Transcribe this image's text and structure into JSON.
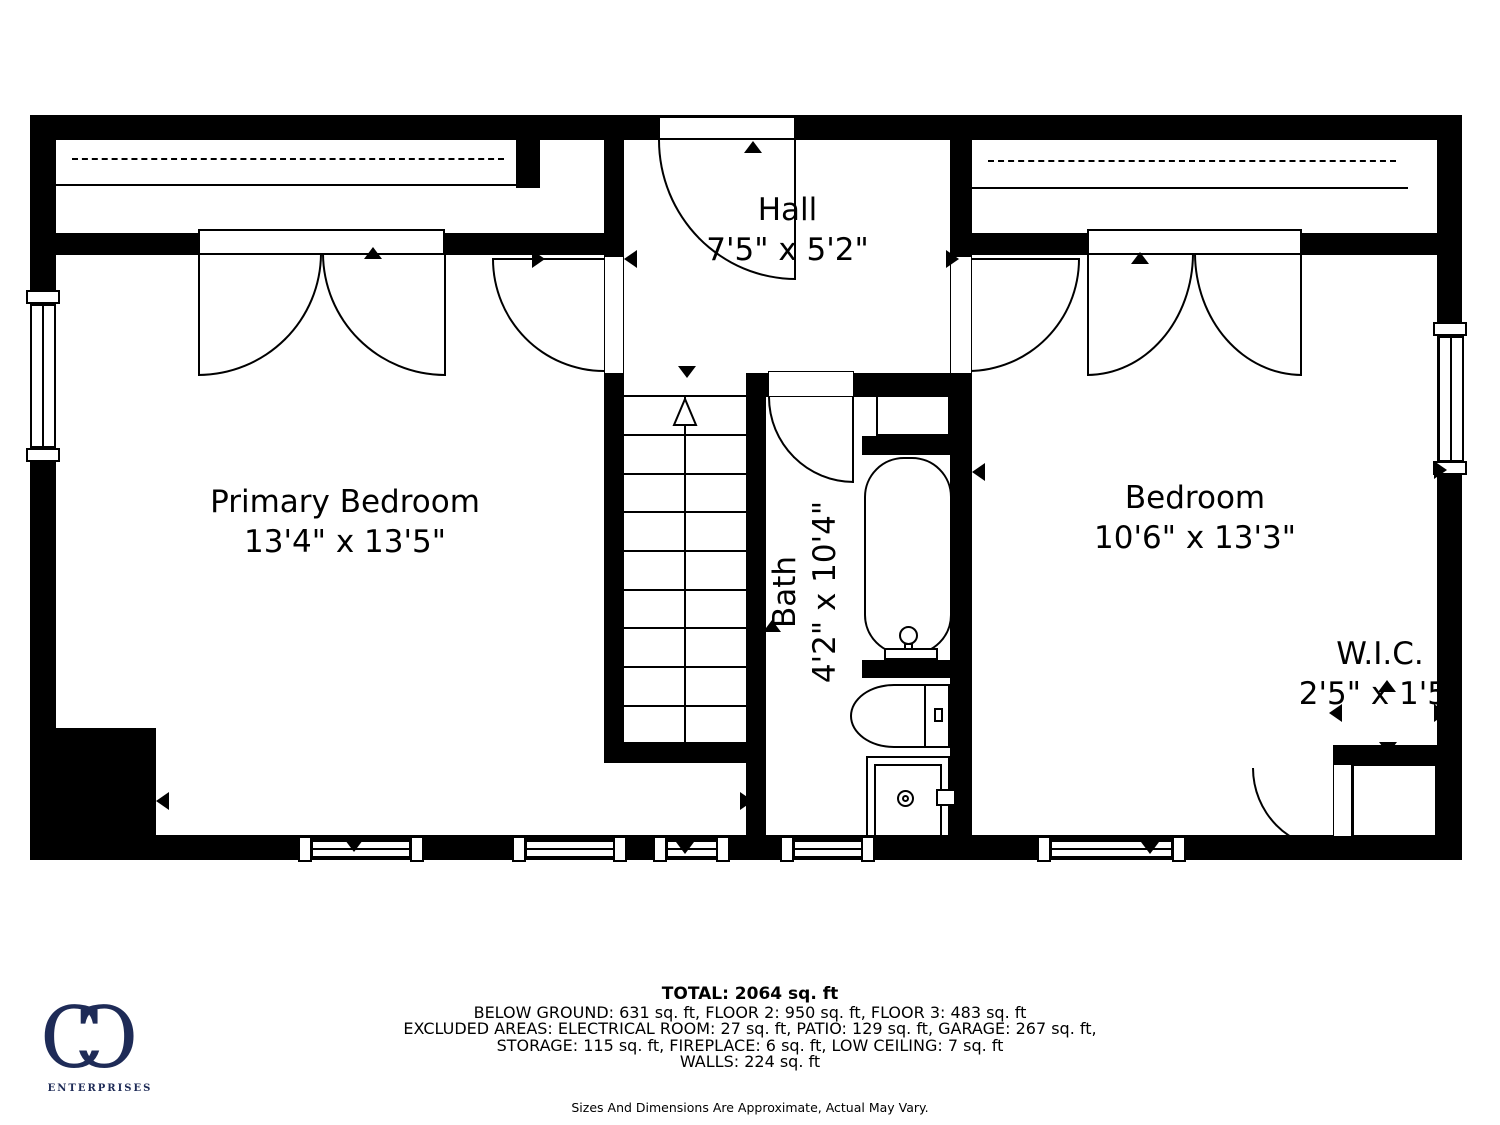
{
  "plan": {
    "rooms": {
      "primary_bedroom": {
        "name": "Primary Bedroom",
        "dimensions": "13'4\" x 13'5\""
      },
      "hall": {
        "name": "Hall",
        "dimensions": "7'5\" x 5'2\""
      },
      "bedroom": {
        "name": "Bedroom",
        "dimensions": "10'6\" x 13'3\""
      },
      "bath": {
        "name": "Bath",
        "dimensions": "4'2\" x 10'4\""
      },
      "wic": {
        "name": "W.I.C.",
        "dimensions": "2'5\" x 1'5\""
      }
    }
  },
  "footer": {
    "total": "TOTAL: 2064 sq. ft",
    "line1": "BELOW GROUND: 631 sq. ft, FLOOR 2: 950 sq. ft, FLOOR 3: 483 sq. ft",
    "line2": "EXCLUDED AREAS: ELECTRICAL ROOM: 27 sq. ft, PATIO: 129 sq. ft, GARAGE: 267 sq. ft,",
    "line3": "STORAGE: 115 sq. ft, FIREPLACE: 6 sq. ft, LOW CEILING: 7 sq. ft",
    "line4": "WALLS: 224 sq. ft",
    "disclaimer": "Sizes And Dimensions Are Approximate, Actual May Vary."
  },
  "logo": {
    "c1": "C",
    "c2": "C",
    "text": "ENTERPRISES"
  },
  "colors": {
    "walls": "#000000",
    "background": "#ffffff",
    "logo": "#1e2b57"
  }
}
